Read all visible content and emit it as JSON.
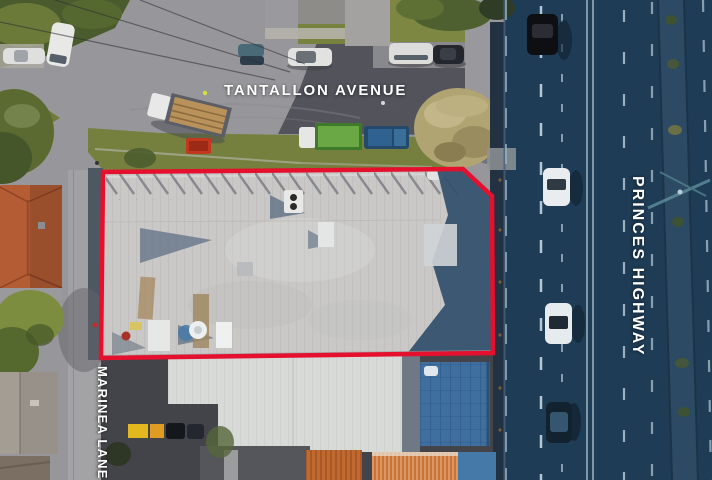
{
  "image": {
    "kind": "aerial-drone-photograph",
    "subject": "commercial warehouse property outlined in red at a street corner"
  },
  "street_labels": {
    "top": "TANTALLON AVENUE",
    "right": "PRINCES HIGHWAY",
    "left": "MARINEA LANE"
  },
  "boundary": {
    "color": "#e50f2e"
  },
  "palette": {
    "road_sunlit": "#97969a",
    "road_shadow": "#52535b",
    "highway_shadow": "#1e3c55",
    "roof_light": "#c9c8c6",
    "lower_roof": "#d7dad6",
    "label_text": "#ffffff",
    "grass": "#76803e",
    "terracotta_roof": "#b45c34"
  }
}
